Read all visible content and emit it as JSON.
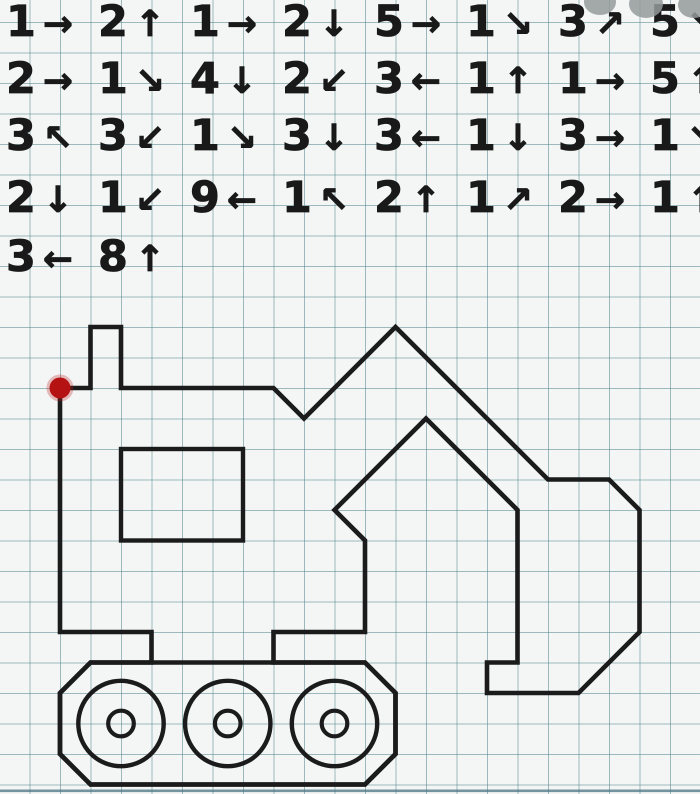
{
  "paper": {
    "background_color": "#f3f6f5",
    "grid_line_color": "rgba(84,134,142,0.55)",
    "grid_cell_px": 30.5,
    "bottom_edge_line_color": "#4a7383"
  },
  "instructions": {
    "text_color": "#191919",
    "rows": [
      {
        "steps": [
          {
            "count": "1",
            "arrow": "→",
            "dir": "right"
          },
          {
            "count": "2",
            "arrow": "↑",
            "dir": "up"
          },
          {
            "count": "1",
            "arrow": "→",
            "dir": "right"
          },
          {
            "count": "2",
            "arrow": "↓",
            "dir": "down"
          },
          {
            "count": "5",
            "arrow": "→",
            "dir": "right"
          },
          {
            "count": "1",
            "arrow": "↘",
            "dir": "down-right"
          },
          {
            "count": "3",
            "arrow": "↗",
            "dir": "up-right"
          },
          {
            "count": "5",
            "arrow": "↘",
            "dir": "down-right"
          }
        ]
      },
      {
        "steps": [
          {
            "count": "2",
            "arrow": "→",
            "dir": "right"
          },
          {
            "count": "1",
            "arrow": "↘",
            "dir": "down-right"
          },
          {
            "count": "4",
            "arrow": "↓",
            "dir": "down"
          },
          {
            "count": "2",
            "arrow": "↙",
            "dir": "down-left"
          },
          {
            "count": "3",
            "arrow": "←",
            "dir": "left"
          },
          {
            "count": "1",
            "arrow": "↑",
            "dir": "up"
          },
          {
            "count": "1",
            "arrow": "→",
            "dir": "right"
          },
          {
            "count": "5",
            "arrow": "↑",
            "dir": "up"
          }
        ]
      },
      {
        "steps": [
          {
            "count": "3",
            "arrow": "↖",
            "dir": "up-left"
          },
          {
            "count": "3",
            "arrow": "↙",
            "dir": "down-left"
          },
          {
            "count": "1",
            "arrow": "↘",
            "dir": "down-right"
          },
          {
            "count": "3",
            "arrow": "↓",
            "dir": "down"
          },
          {
            "count": "3",
            "arrow": "←",
            "dir": "left"
          },
          {
            "count": "1",
            "arrow": "↓",
            "dir": "down"
          },
          {
            "count": "3",
            "arrow": "→",
            "dir": "right"
          },
          {
            "count": "1",
            "arrow": "↘",
            "dir": "down-right"
          }
        ]
      },
      {
        "steps": [
          {
            "count": "2",
            "arrow": "↓",
            "dir": "down"
          },
          {
            "count": "1",
            "arrow": "↙",
            "dir": "down-left"
          },
          {
            "count": "9",
            "arrow": "←",
            "dir": "left"
          },
          {
            "count": "1",
            "arrow": "↖",
            "dir": "up-left"
          },
          {
            "count": "2",
            "arrow": "↑",
            "dir": "up"
          },
          {
            "count": "1",
            "arrow": "↗",
            "dir": "up-right"
          },
          {
            "count": "2",
            "arrow": "→",
            "dir": "right"
          },
          {
            "count": "1",
            "arrow": "↑",
            "dir": "up"
          }
        ]
      },
      {
        "steps": [
          {
            "count": "3",
            "arrow": "←",
            "dir": "left"
          },
          {
            "count": "8",
            "arrow": "↑",
            "dir": "up"
          }
        ]
      }
    ]
  },
  "figure": {
    "grid_cell_px": 30.5,
    "origin_px": {
      "x": 60,
      "y": 388
    },
    "stroke_color": "#1b1b1b",
    "stroke_width": 4.6,
    "start_dot": {
      "gx": 0,
      "gy": 0,
      "radius_px": 10.5,
      "color": "#b51313",
      "halo_color": "rgba(190,25,25,0.28)"
    },
    "outline_points_grid": [
      [
        0,
        0
      ],
      [
        1,
        0
      ],
      [
        1,
        -2
      ],
      [
        2,
        -2
      ],
      [
        2,
        0
      ],
      [
        7,
        0
      ],
      [
        8,
        1
      ],
      [
        11,
        -2
      ],
      [
        16,
        3
      ],
      [
        18,
        3
      ],
      [
        19,
        4
      ],
      [
        19,
        8
      ],
      [
        17,
        10
      ],
      [
        14,
        10
      ],
      [
        14,
        9
      ],
      [
        15,
        9
      ],
      [
        15,
        4
      ],
      [
        12,
        1
      ],
      [
        9,
        4
      ],
      [
        10,
        5
      ],
      [
        10,
        8
      ],
      [
        7,
        8
      ],
      [
        7,
        9
      ],
      [
        10,
        9
      ],
      [
        11,
        10
      ],
      [
        11,
        12
      ],
      [
        10,
        13
      ],
      [
        1,
        13
      ],
      [
        0,
        12
      ],
      [
        0,
        10
      ],
      [
        1,
        9
      ],
      [
        3,
        9
      ],
      [
        3,
        8
      ],
      [
        0,
        8
      ]
    ],
    "track_pad_points_grid": [
      [
        0,
        10
      ],
      [
        1,
        9
      ],
      [
        10,
        9
      ],
      [
        11,
        10
      ],
      [
        11,
        12
      ],
      [
        10,
        13
      ],
      [
        1,
        13
      ],
      [
        0,
        12
      ]
    ],
    "cab_window_rect_grid": {
      "x1": 2,
      "y1": 2,
      "x2": 6,
      "y2": 5
    },
    "wheels_grid": [
      {
        "cx": 2,
        "cy": 11
      },
      {
        "cx": 5.5,
        "cy": 11
      },
      {
        "cx": 9,
        "cy": 11
      }
    ],
    "wheel_outer_radius_grid": 1.4,
    "wheel_inner_radius_grid": 0.42
  },
  "watermark": {
    "color": "rgba(148,154,154,0.85)",
    "blobs": [
      {
        "cx": 600,
        "cy": 2,
        "rx": 16,
        "ry": 13
      },
      {
        "cx": 646,
        "cy": 4,
        "rx": 17,
        "ry": 14
      },
      {
        "cx": 694,
        "cy": 5,
        "rx": 16,
        "ry": 13
      }
    ]
  }
}
